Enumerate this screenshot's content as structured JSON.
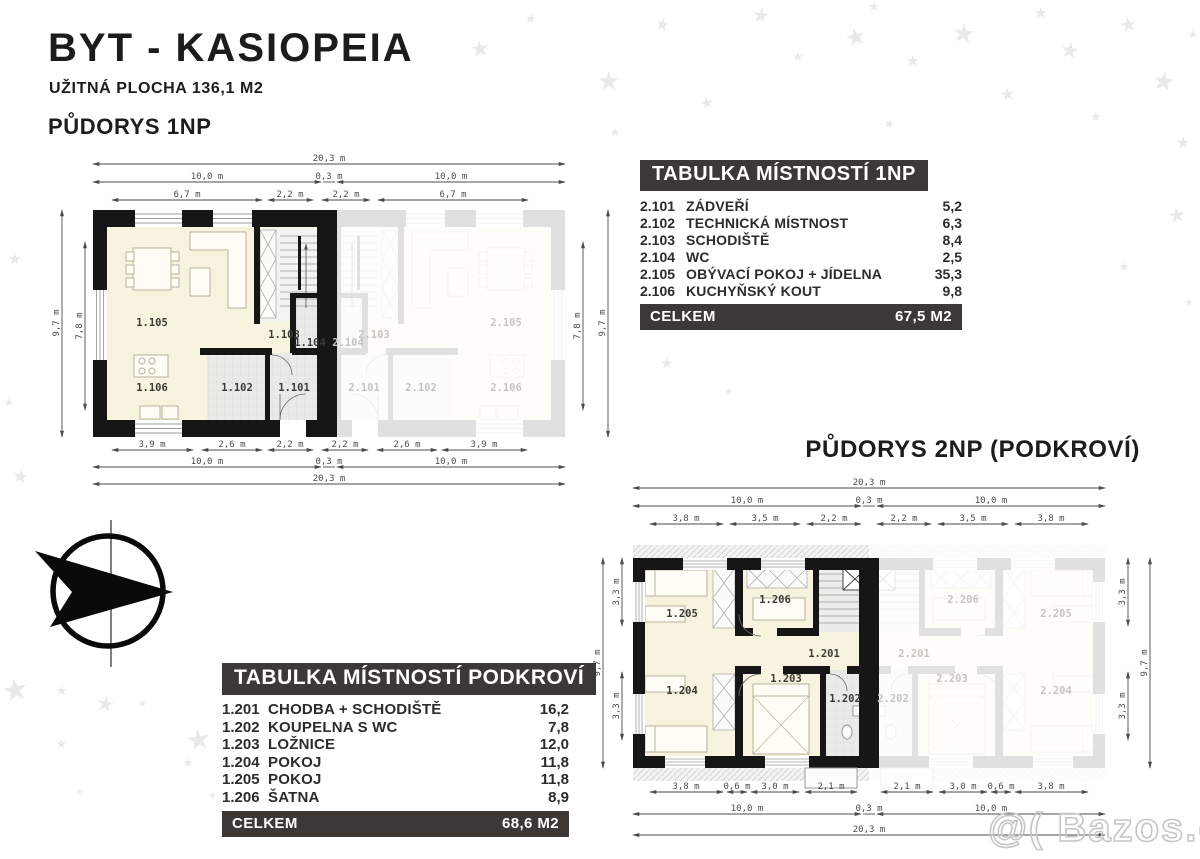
{
  "header": {
    "title": "BYT - KASIOPEIA",
    "subtitle": "UŽITNÁ PLOCHA 136,1 M2"
  },
  "plan1": {
    "heading": "PŮDORYS 1NP",
    "dims": {
      "top": [
        [
          "20,3 m"
        ],
        [
          "10,0 m",
          "0,3 m",
          "10,0 m"
        ],
        [
          "6,7 m",
          "2,2 m",
          "2,2 m",
          "6,7 m"
        ]
      ],
      "bottom": [
        [
          "3,9 m",
          "2,6 m",
          "2,2 m",
          "2,2 m",
          "2,6 m",
          "3,9 m"
        ],
        [
          "10,0 m",
          "0,3 m",
          "10,0 m"
        ],
        [
          "20,3 m"
        ]
      ],
      "left": [
        "9,7 m",
        "7,8 m"
      ],
      "right": [
        "7,8 m",
        "9,7 m"
      ]
    },
    "rooms": {
      "living": "1.105",
      "kitchen": "1.106",
      "stairs": "1.103",
      "wc": "1.104",
      "tech": "1.102",
      "entry": "1.101"
    },
    "rooms_faded": {
      "living": "2.105",
      "kitchen": "2.106",
      "stairs": "2.103",
      "wc": "2.104",
      "tech": "2.102",
      "entry": "2.101"
    }
  },
  "plan2": {
    "heading": "PŮDORYS 2NP (PODKROVÍ)",
    "dims": {
      "top": [
        [
          "20,3 m"
        ],
        [
          "10,0 m",
          "0,3 m",
          "10,0 m"
        ],
        [
          "3,8 m",
          "3,5 m",
          "2,2 m",
          "2,2 m",
          "3,5 m",
          "3,8 m"
        ]
      ],
      "bottom": [
        [
          "3,8 m",
          "0,6 m",
          "3,0 m",
          "2,1 m",
          "2,1 m",
          "3,0 m",
          "0,6 m",
          "3,8 m"
        ],
        [
          "10,0 m",
          "0,3 m",
          "10,0 m"
        ],
        [
          "20,3 m"
        ]
      ],
      "left": [
        "9,7 m",
        "3,3 m",
        "3,3 m"
      ],
      "right": [
        "3,3 m",
        "3,3 m",
        "9,7 m"
      ]
    },
    "rooms": {
      "hall": "1.201",
      "bath": "1.202",
      "bedroom": "1.203",
      "room_a": "1.204",
      "room_b": "1.205",
      "closet": "1.206"
    },
    "rooms_faded": {
      "hall": "2.201",
      "bath": "2.202",
      "bedroom": "2.203",
      "room_a": "2.204",
      "room_b": "2.205",
      "closet": "2.206"
    }
  },
  "table_1np": {
    "heading": "TABULKA MÍSTNOSTÍ 1NP",
    "rows": [
      {
        "id": "2.101",
        "name": "ZÁDVEŘÍ",
        "area": "5,2"
      },
      {
        "id": "2.102",
        "name": "TECHNICKÁ MÍSTNOST",
        "area": "6,3"
      },
      {
        "id": "2.103",
        "name": "SCHODIŠTĚ",
        "area": "8,4"
      },
      {
        "id": "2.104",
        "name": "WC",
        "area": "2,5"
      },
      {
        "id": "2.105",
        "name": "OBÝVACÍ POKOJ + JÍDELNA",
        "area": "35,3"
      },
      {
        "id": "2.106",
        "name": "KUCHYŇSKÝ KOUT",
        "area": "9,8"
      }
    ],
    "total_label": "CELKEM",
    "total_value": "67,5 M2"
  },
  "table_podkrovi": {
    "heading": "TABULKA MÍSTNOSTÍ PODKROVÍ",
    "rows": [
      {
        "id": "1.201",
        "name": "CHODBA + SCHODIŠTĚ",
        "area": "16,2"
      },
      {
        "id": "1.202",
        "name": "KOUPELNA S WC",
        "area": "7,8"
      },
      {
        "id": "1.203",
        "name": "LOŽNICE",
        "area": "12,0"
      },
      {
        "id": "1.204",
        "name": "POKOJ",
        "area": "11,8"
      },
      {
        "id": "1.205",
        "name": "POKOJ",
        "area": "11,8"
      },
      {
        "id": "1.206",
        "name": "ŠATNA",
        "area": "8,9"
      }
    ],
    "total_label": "CELKEM",
    "total_value": "68,6 M2"
  },
  "watermark": "@( Bazos.cz",
  "colors": {
    "bar": "#3b3835",
    "wall": "#161616",
    "floor_beige": "#f8f3de",
    "floor_gray": "#eaeae8",
    "star": "#e9e9e9"
  }
}
